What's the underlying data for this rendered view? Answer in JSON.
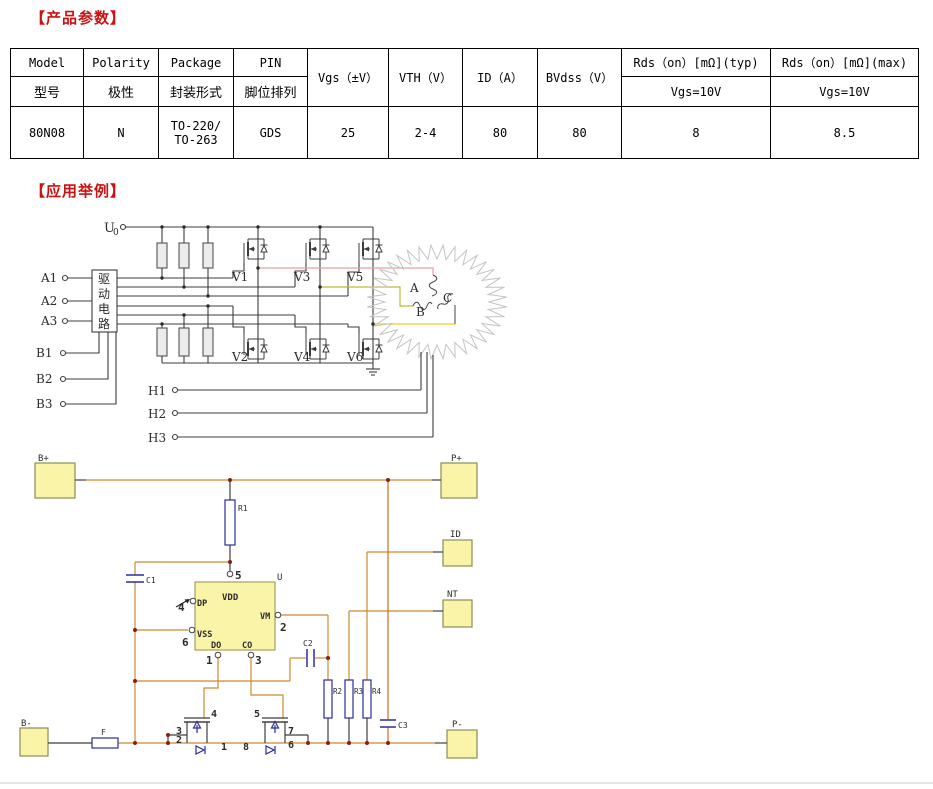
{
  "sections": {
    "params_title": "【产品参数】",
    "examples_title": "【应用举例】"
  },
  "table": {
    "h1": [
      "Model",
      "Polarity",
      "Package",
      "PIN",
      "Vgs（±V）",
      "VTH（V）",
      "ID（A）",
      "BVdss（V）",
      "Rds（on）[mΩ](typ)",
      "Rds（on）[mΩ](max)"
    ],
    "h2": [
      "型号",
      "极性",
      "封装形式",
      "脚位排列",
      "Vgs=10V",
      "Vgs=10V"
    ],
    "d": [
      "80N08",
      "N",
      "GDS",
      "25",
      "2-4",
      "80",
      "80",
      "8",
      "8.5"
    ],
    "d_package": [
      "TO-220/",
      "TO-263"
    ]
  },
  "d1": {
    "supply": "U",
    "supply_sub": "0",
    "a_inputs": [
      "A1",
      "A2",
      "A3"
    ],
    "b_inputs": [
      "B1",
      "B2",
      "B3"
    ],
    "halls": [
      "H1",
      "H2",
      "H3"
    ],
    "drive_box": [
      "驱",
      "动",
      "电",
      "路"
    ],
    "fets": [
      "V1",
      "V2",
      "V3",
      "V4",
      "V5",
      "V6"
    ],
    "phases": [
      "A",
      "B",
      "C"
    ]
  },
  "d2": {
    "pads": {
      "bp": "B+",
      "pp": "P+",
      "id": "ID",
      "nt": "NT",
      "bm": "B-",
      "pm": "P-"
    },
    "refs": {
      "r1": "R1",
      "r2": "R2",
      "r3": "R3",
      "r4": "R4",
      "c1": "C1",
      "c2": "C2",
      "c3": "C3",
      "f": "F",
      "u": "U"
    },
    "ic": {
      "vdd": "VDD",
      "dp": "DP",
      "vss": "VSS",
      "do": "DO",
      "co": "CO",
      "vm": "VM",
      "p5": "5",
      "p4": "4",
      "p6": "6",
      "p1": "1",
      "p3": "3",
      "p2": "2"
    },
    "q1": {
      "p4": "4",
      "p3": "3",
      "p2": "2",
      "p1": "1"
    },
    "q2": {
      "p5": "5",
      "p8": "8",
      "p7": "7",
      "p6": "6"
    }
  },
  "colors": {
    "title_red": "#cc1111",
    "wire_orange": "#cf8a2e",
    "wire_orange_dark": "#c96e1e",
    "component_blue": "#2b2b9e",
    "junction_red": "#8c1d12",
    "pad_fill": "#f9f4a8",
    "phase_pink": "#e8a0a0",
    "phase_olive": "#bcbb35",
    "phase_yellow": "#eed22a"
  }
}
